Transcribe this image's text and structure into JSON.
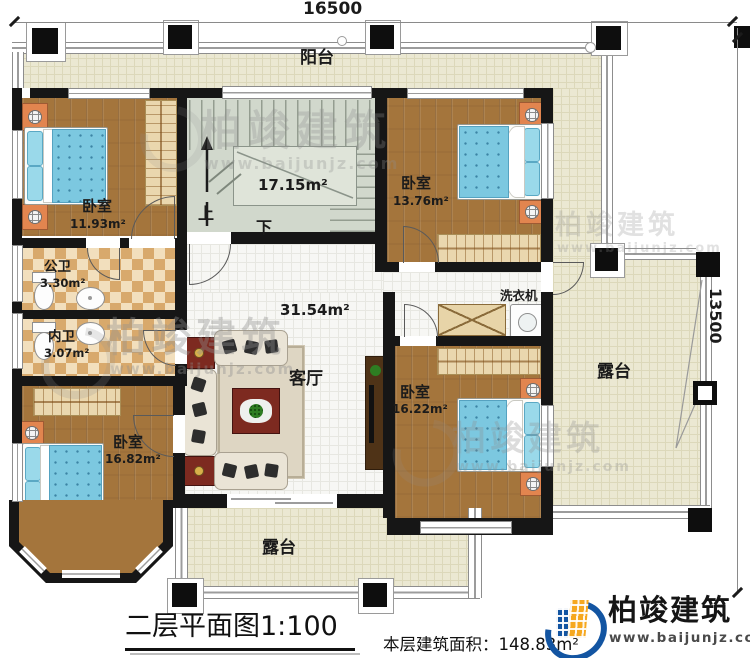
{
  "dims": {
    "top": "16500",
    "right": "13500"
  },
  "rooms": {
    "balcony": {
      "label": "阳台"
    },
    "stairwell": {
      "area": "17.15m²",
      "up": "上",
      "down": "下"
    },
    "bedroom_tl": {
      "label": "卧室",
      "area": "11.93m²"
    },
    "bedroom_tr": {
      "label": "卧室",
      "area": "13.76m²"
    },
    "bath_public": {
      "label": "公卫",
      "area": "3.30m²"
    },
    "bath_inner": {
      "label": "内卫",
      "area": "3.07m²"
    },
    "living": {
      "label": "客厅",
      "area": "31.54m²"
    },
    "bedroom_bl": {
      "label": "卧室",
      "area": "16.82m²"
    },
    "bedroom_br": {
      "label": "卧室",
      "area": "16.22m²"
    },
    "laundry": {
      "label": "洗衣机"
    },
    "terrace_right": {
      "label": "露台"
    },
    "terrace_bottom": {
      "label": "露台"
    }
  },
  "titleblock": {
    "plan_title": "二层平面图1:100",
    "area_label": "本层建筑面积：",
    "area_value": "148.83m²"
  },
  "brand": {
    "name": "柏竣建筑",
    "url": "www.baijunjz.com"
  },
  "watermark": {
    "name": "柏竣建筑",
    "url": "www.baijunjz.com"
  },
  "colors": {
    "accent_blue": "#1355a2",
    "accent_orange": "#f6a81f",
    "wall": "#161616"
  }
}
